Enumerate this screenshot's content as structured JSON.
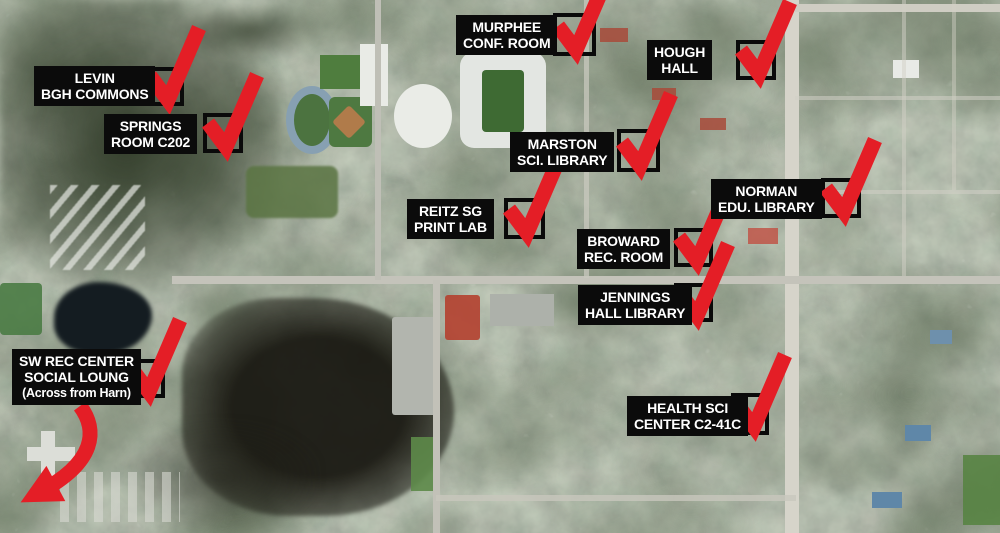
{
  "graphic": {
    "kind": "annotated aerial campus map",
    "colors": {
      "check_red": "#e41e26",
      "label_bg": "#0b0b0b",
      "label_text": "#ffffff"
    },
    "icons": [
      "checkmark-icon",
      "checkbox-frame",
      "curved-arrow-icon"
    ]
  },
  "markers": [
    {
      "name": "murphee-conf-room",
      "lines": [
        "MURPHEE",
        "CONF. ROOM"
      ]
    },
    {
      "name": "hough-hall",
      "lines": [
        "HOUGH",
        "HALL"
      ]
    },
    {
      "name": "levin-bgh-commons",
      "lines": [
        "LEVIN",
        "BGH COMMONS"
      ]
    },
    {
      "name": "springs-room-c202",
      "lines": [
        "SPRINGS",
        "ROOM C202"
      ]
    },
    {
      "name": "marston-sci-library",
      "lines": [
        "MARSTON",
        "SCI. LIBRARY"
      ]
    },
    {
      "name": "reitz-sg-print-lab",
      "lines": [
        "REITZ SG",
        "PRINT LAB"
      ]
    },
    {
      "name": "norman-edu-library",
      "lines": [
        "NORMAN",
        "EDU. LIBRARY"
      ]
    },
    {
      "name": "broward-rec-room",
      "lines": [
        "BROWARD",
        "REC. ROOM"
      ]
    },
    {
      "name": "jennings-hall-library",
      "lines": [
        "JENNINGS",
        "HALL LIBRARY"
      ]
    },
    {
      "name": "sw-rec-center",
      "lines": [
        "SW REC CENTER",
        "SOCIAL LOUNG",
        "(Across from Harn)"
      ]
    },
    {
      "name": "health-sci-center",
      "lines": [
        "HEALTH SCI",
        "CENTER C2-41C"
      ]
    }
  ]
}
